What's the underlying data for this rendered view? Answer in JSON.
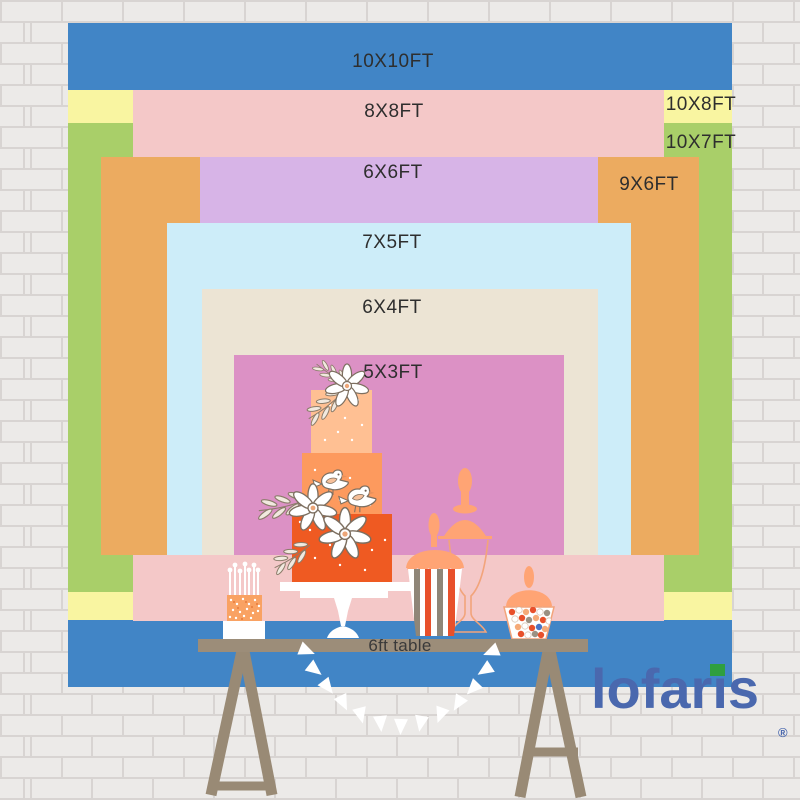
{
  "backdrop_chart": {
    "description_labels_order": "largest to smallest as shown top to bottom",
    "sizes": [
      {
        "label": "10X10FT",
        "width_ft": 10,
        "height_ft": 10,
        "color": "#4185c6"
      },
      {
        "label": "8X8FT",
        "width_ft": 8,
        "height_ft": 8,
        "color": "#f4c8c8"
      },
      {
        "label": "10X8FT",
        "width_ft": 10,
        "height_ft": 8,
        "color": "#f9f5a1"
      },
      {
        "label": "10X7FT",
        "width_ft": 10,
        "height_ft": 7,
        "color": "#a9cf69"
      },
      {
        "label": "6X6FT",
        "width_ft": 6,
        "height_ft": 6,
        "color": "#d7b4e7"
      },
      {
        "label": "9X6FT",
        "width_ft": 9,
        "height_ft": 6,
        "color": "#ecab60"
      },
      {
        "label": "7X5FT",
        "width_ft": 7,
        "height_ft": 5,
        "color": "#cdedf9"
      },
      {
        "label": "6X4FT",
        "width_ft": 6,
        "height_ft": 4,
        "color": "#ece4d4"
      },
      {
        "label": "5X3FT",
        "width_ft": 5,
        "height_ft": 3,
        "color": "#dc91c5"
      }
    ],
    "table_label": "6ft table"
  },
  "brand": {
    "name": "lofaris",
    "logo_parts": [
      "lofar",
      "i",
      "s"
    ],
    "registered_mark": "®",
    "logo_color": "#4a68ae",
    "logo_accent_color": "#2f9f3f"
  }
}
